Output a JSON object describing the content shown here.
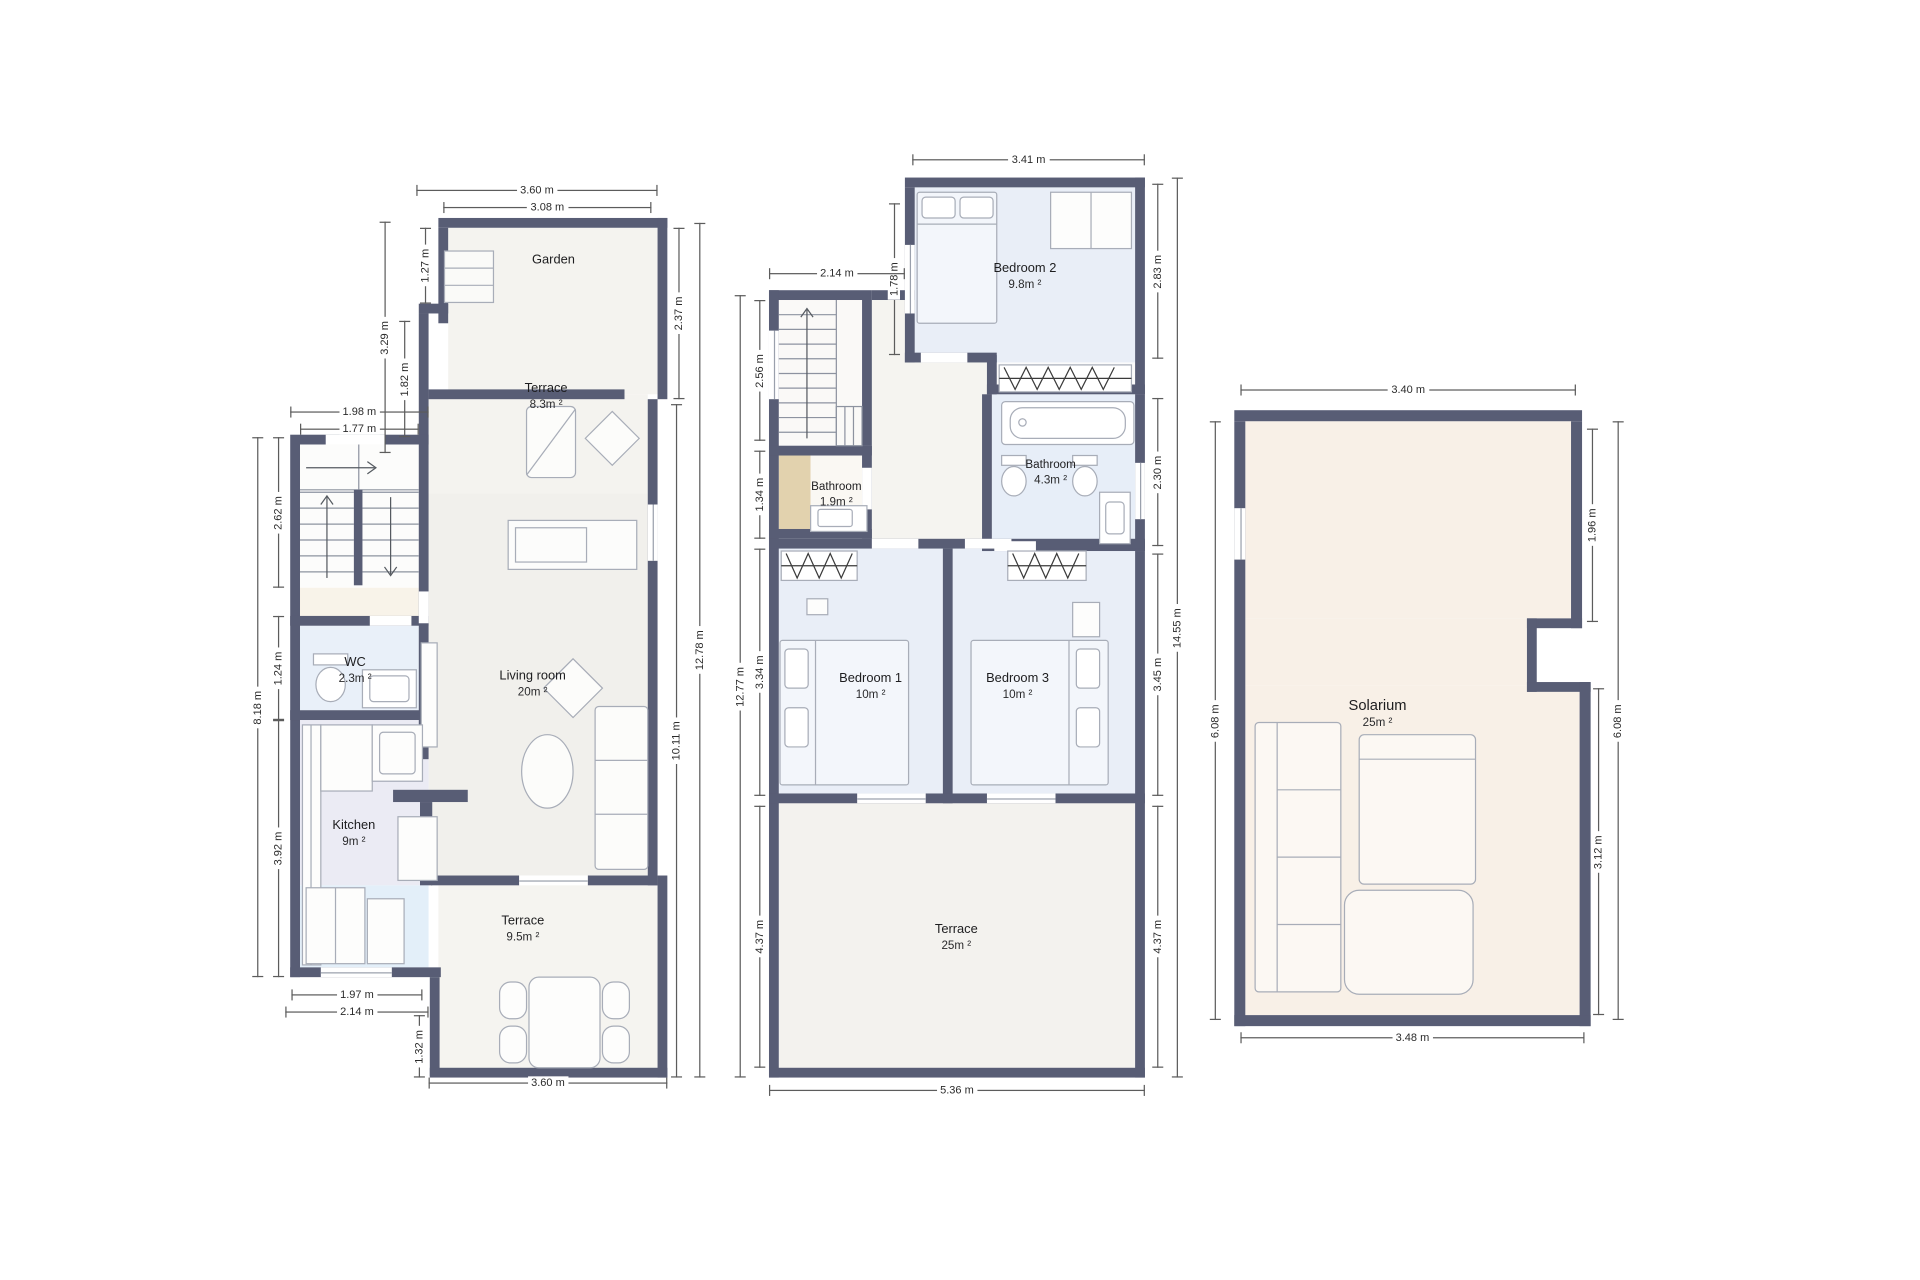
{
  "colors": {
    "wall": "#585d75",
    "floor_cream": "#f4f3ef",
    "floor_living": "#f1f0ec",
    "floor_blue_room": "#e9eef7",
    "floor_wc_blue": "#e9f0f9",
    "floor_kitchen": "#ebebf4",
    "floor_kitchen_blue": "#e3eff9",
    "floor_hall_beige": "#f8f3e9",
    "floor_bath_tan": "#e2d2ae",
    "floor_solarium": "#f8f0e7"
  },
  "ground_floor": {
    "rooms": {
      "garden": {
        "name": "Garden",
        "area": ""
      },
      "terrace_upper": {
        "name": "Terrace",
        "area": "8.3m ²"
      },
      "living_room": {
        "name": "Living room",
        "area": "20m ²"
      },
      "wc": {
        "name": "WC",
        "area": "2.3m ²"
      },
      "kitchen": {
        "name": "Kitchen",
        "area": "9m ²"
      },
      "terrace_lower": {
        "name": "Terrace",
        "area": "9.5m ²"
      }
    },
    "dims": {
      "top_outer": "3.60 m",
      "top_inner": "3.08 m",
      "garden_left": "1.27 m",
      "upper_left_outer": "3.29 m",
      "terrace_left": "1.82 m",
      "stairs_width_outer": "1.98 m",
      "stairs_width_inner": "1.77 m",
      "stairs_height": "2.62 m",
      "wc_height": "1.24 m",
      "kitchen_height": "3.92 m",
      "left_total": "8.18 m",
      "garden_right": "2.37 m",
      "right_total": "12.78 m",
      "right_inner": "10.11 m",
      "bottom_door": "1.97 m",
      "bottom_inner": "2.14 m",
      "bottom_step": "1.32 m",
      "terrace_bottom": "3.60 m"
    }
  },
  "first_floor": {
    "rooms": {
      "bedroom2": {
        "name": "Bedroom 2",
        "area": "9.8m ²"
      },
      "bathroom_small": {
        "name": "Bathroom",
        "area": "1.9m ²"
      },
      "bathroom": {
        "name": "Bathroom",
        "area": "4.3m ²"
      },
      "bedroom1": {
        "name": "Bedroom 1",
        "area": "10m ²"
      },
      "bedroom3": {
        "name": "Bedroom 3",
        "area": "10m ²"
      },
      "terrace": {
        "name": "Terrace",
        "area": "25m ²"
      }
    },
    "dims": {
      "bedroom2_top": "3.41 m",
      "bedroom2_window": "1.78 m",
      "bedroom2_right": "2.83 m",
      "stairs_top": "2.14 m",
      "stairs_left": "2.56 m",
      "bathroom_small_left": "1.34 m",
      "bedroom1_left": "3.34 m",
      "terrace_left": "4.37 m",
      "left_total": "12.77 m",
      "bathroom_right": "2.30 m",
      "bedroom3_right": "3.45 m",
      "terrace_right": "4.37 m",
      "right_total": "14.55 m",
      "bottom": "5.36 m"
    }
  },
  "top_floor": {
    "rooms": {
      "solarium": {
        "name": "Solarium",
        "area": "25m ²"
      }
    },
    "dims": {
      "top": "3.40 m",
      "left": "6.08 m",
      "right_upper": "1.96 m",
      "right_lower": "3.12 m",
      "right_total": "6.08 m",
      "bottom": "3.48 m"
    }
  }
}
